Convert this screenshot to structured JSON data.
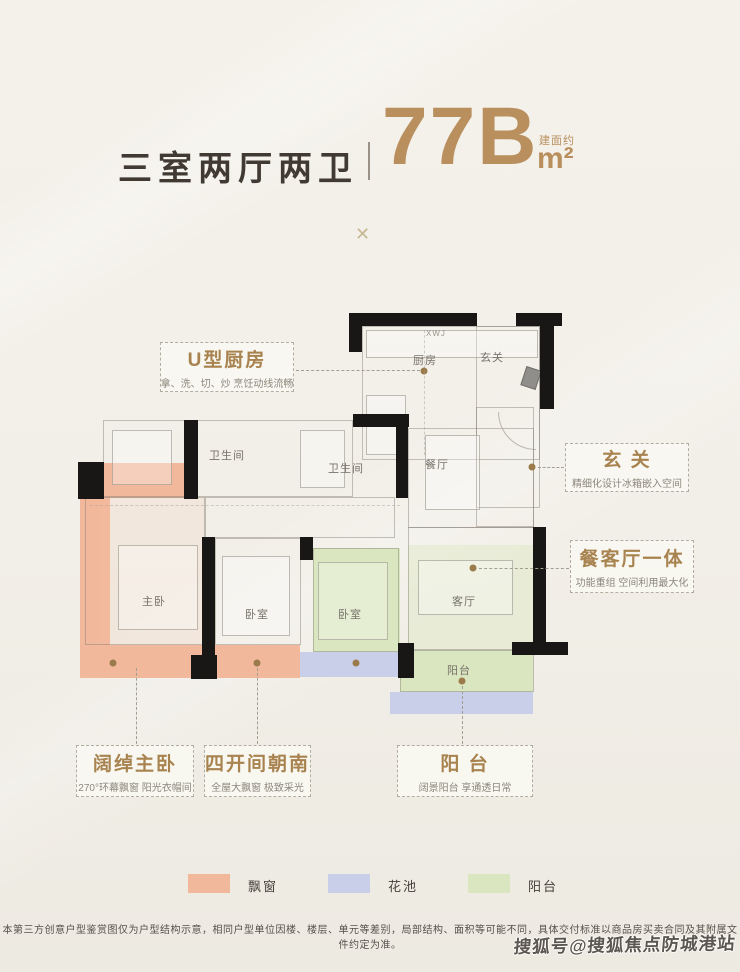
{
  "page": {
    "background": "#f3f0e9"
  },
  "header": {
    "title": "三室两厅两卫",
    "divider_glyph": "|",
    "unit_code": "77B",
    "area_prefix": "建面约",
    "area_unit": "m²",
    "accent_color": "#b98f5e"
  },
  "decor": {
    "separator_glyph": "✕"
  },
  "floorplan": {
    "appliance_tag": "XWJ",
    "rooms": [
      {
        "id": "kitchen",
        "label": "厨房"
      },
      {
        "id": "foyer",
        "label": "玄关"
      },
      {
        "id": "bathroom-1",
        "label": "卫生间"
      },
      {
        "id": "bathroom-2",
        "label": "卫生间"
      },
      {
        "id": "dining",
        "label": "餐厅"
      },
      {
        "id": "master-bedroom",
        "label": "主卧"
      },
      {
        "id": "bedroom-2",
        "label": "卧室"
      },
      {
        "id": "bedroom-3",
        "label": "卧室"
      },
      {
        "id": "living-room",
        "label": "客厅"
      },
      {
        "id": "balcony",
        "label": "阳台"
      }
    ]
  },
  "callouts": [
    {
      "id": "kitchen",
      "title": "U型厨房",
      "subtitle": "拿、洗、切、炒 烹饪动线流畅"
    },
    {
      "id": "foyer",
      "title": "玄 关",
      "subtitle": "精细化设计冰箱嵌入空间"
    },
    {
      "id": "dining-living",
      "title": "餐客厅一体",
      "subtitle": "功能重组 空间利用最大化"
    },
    {
      "id": "master-bedroom",
      "title": "阔绰主卧",
      "subtitle": "270°环幕飘窗 阳光衣帽间"
    },
    {
      "id": "south-facing",
      "title": "四开间朝南",
      "subtitle": "全屋大飘窗 极致采光"
    },
    {
      "id": "balcony",
      "title": "阳 台",
      "subtitle": "阔景阳台 享通透日常"
    }
  ],
  "legend": [
    {
      "label": "飘窗",
      "color": "#f2b89c"
    },
    {
      "label": "花池",
      "color": "#c9cfe8"
    },
    {
      "label": "阳台",
      "color": "#d9e6bf"
    }
  ],
  "footer": {
    "disclaimer": "本第三方创意户型鉴赏图仅为户型结构示意，相同户型单位因楼、楼层、单元等差别，局部结构、面积等可能不同，具体交付标准以商品房买卖合同及其附属文件约定为准。",
    "watermark": "搜狐号@搜狐焦点防城港站"
  }
}
